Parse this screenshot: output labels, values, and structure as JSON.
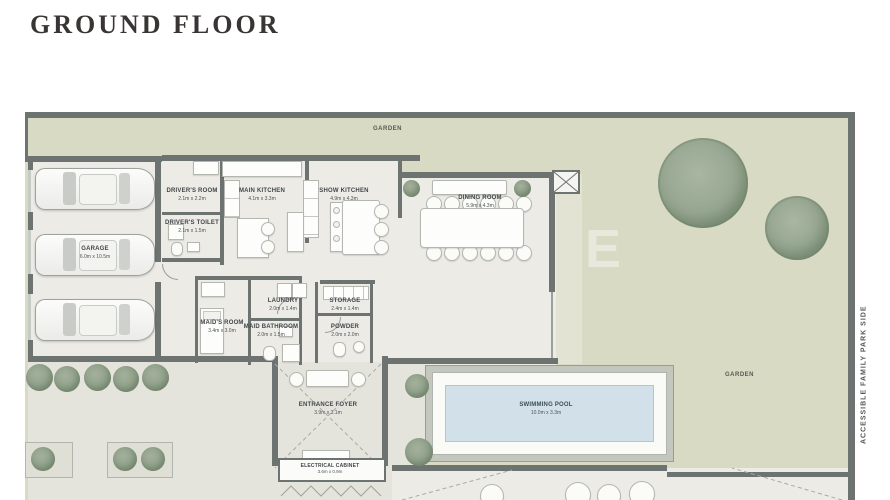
{
  "title": "GROUND FLOOR",
  "plan": {
    "garden_top": "GARDEN",
    "garden_right": "GARDEN",
    "side_text": "ACCESSIBLE FAMILY PARK SIDE",
    "watermark": "E",
    "rooms": [
      {
        "name": "GARAGE",
        "dims": "6.0m x 10.5m"
      },
      {
        "name": "DRIVER'S ROOM",
        "dims": "2.1m x 2.2m"
      },
      {
        "name": "DRIVER'S TOILET",
        "dims": "2.1m x 1.5m"
      },
      {
        "name": "MAIN KITCHEN",
        "dims": "4.1m x 3.3m"
      },
      {
        "name": "SHOW KITCHEN",
        "dims": "4.9m x 4.3m"
      },
      {
        "name": "DINING ROOM",
        "dims": "5.9m x 4.3m"
      },
      {
        "name": "LAUNDRY",
        "dims": "2.0m x 1.4m"
      },
      {
        "name": "STORAGE",
        "dims": "2.4m x 1.4m"
      },
      {
        "name": "MAID'S ROOM",
        "dims": "3.4m x 3.0m"
      },
      {
        "name": "MAID BATHROOM",
        "dims": "2.0m x 1.5m"
      },
      {
        "name": "POWDER",
        "dims": "2.0m x 2.0m"
      },
      {
        "name": "ENTRANCE FOYER",
        "dims": "3.9m x 3.1m"
      },
      {
        "name": "ELECTRICAL CABINET",
        "dims": "3.6m x 0.9m"
      },
      {
        "name": "SWIMMING POOL",
        "dims": "10.0m x 3.3m"
      }
    ],
    "colors": {
      "wall": "#6d7370",
      "garden": "#d8dac3",
      "floor": "#ecebe6",
      "pool_water": "#d2e1e9"
    }
  }
}
